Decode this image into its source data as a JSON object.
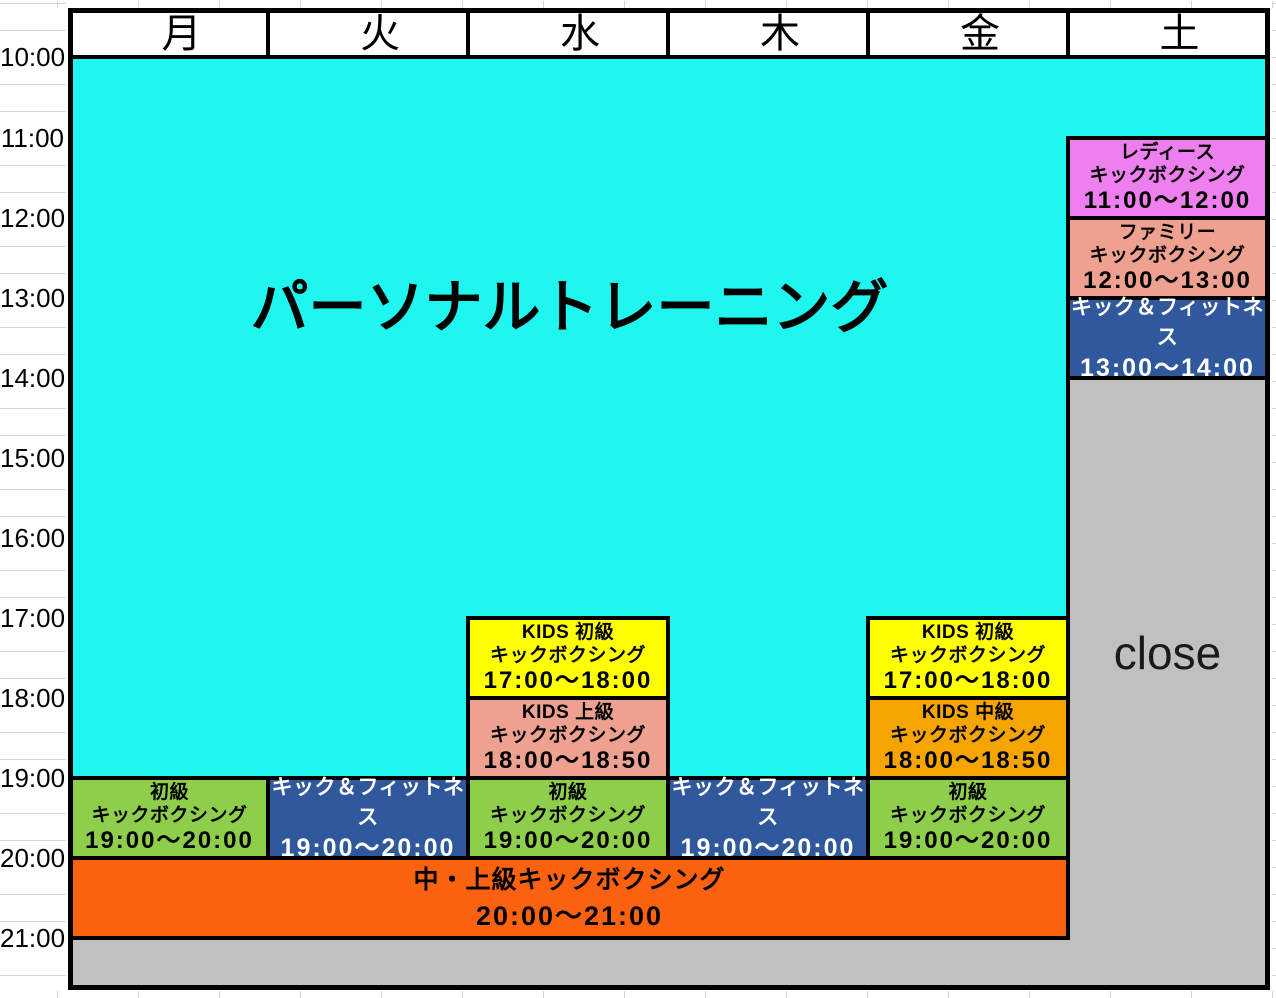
{
  "header": {
    "days": [
      "月",
      "火",
      "水",
      "木",
      "金",
      "土"
    ]
  },
  "time_axis": [
    "10:00",
    "11:00",
    "12:00",
    "13:00",
    "14:00",
    "15:00",
    "16:00",
    "17:00",
    "18:00",
    "19:00",
    "20:00",
    "21:00"
  ],
  "main_block": {
    "label": "パーソナルトレーニング",
    "color": "#1FF6F0"
  },
  "closed": {
    "label": "close",
    "color": "#C0C0C0"
  },
  "schedule": [
    {
      "day": "土",
      "title": "レディース",
      "subtitle": "キックボクシング",
      "time": "11:00〜12:00",
      "color": "#EE7FEE"
    },
    {
      "day": "土",
      "title": "ファミリー",
      "subtitle": "キックボクシング",
      "time": "12:00〜13:00",
      "color": "#EEA091"
    },
    {
      "day": "土",
      "title": "キック＆フィットネス",
      "time": "13:00〜14:00",
      "color": "#30589C"
    },
    {
      "day": "水",
      "title": "KIDS 初級",
      "subtitle": "キックボクシング",
      "time": "17:00〜18:00",
      "color": "#FFFF00"
    },
    {
      "day": "水",
      "title": "KIDS 上級",
      "subtitle": "キックボクシング",
      "time": "18:00〜18:50",
      "color": "#EEA091"
    },
    {
      "day": "金",
      "title": "KIDS 初級",
      "subtitle": "キックボクシング",
      "time": "17:00〜18:00",
      "color": "#FFFF00"
    },
    {
      "day": "金",
      "title": "KIDS 中級",
      "subtitle": "キックボクシング",
      "time": "18:00〜18:50",
      "color": "#F6A500"
    },
    {
      "day": "月",
      "title": "初級",
      "subtitle": "キックボクシング",
      "time": "19:00〜20:00",
      "color": "#8FCE4A"
    },
    {
      "day": "火",
      "title": "キック＆フィットネス",
      "time": "19:00〜20:00",
      "color": "#30589C"
    },
    {
      "day": "水",
      "title": "初級",
      "subtitle": "キックボクシング",
      "time": "19:00〜20:00",
      "color": "#8FCE4A"
    },
    {
      "day": "木",
      "title": "キック＆フィットネス",
      "time": "19:00〜20:00",
      "color": "#30589C"
    },
    {
      "day": "金",
      "title": "初級",
      "subtitle": "キックボクシング",
      "time": "19:00〜20:00",
      "color": "#8FCE4A"
    },
    {
      "day": "月〜金",
      "title": "中・上級キックボクシング",
      "time": "20:00〜21:00",
      "color": "#FB6210"
    }
  ]
}
